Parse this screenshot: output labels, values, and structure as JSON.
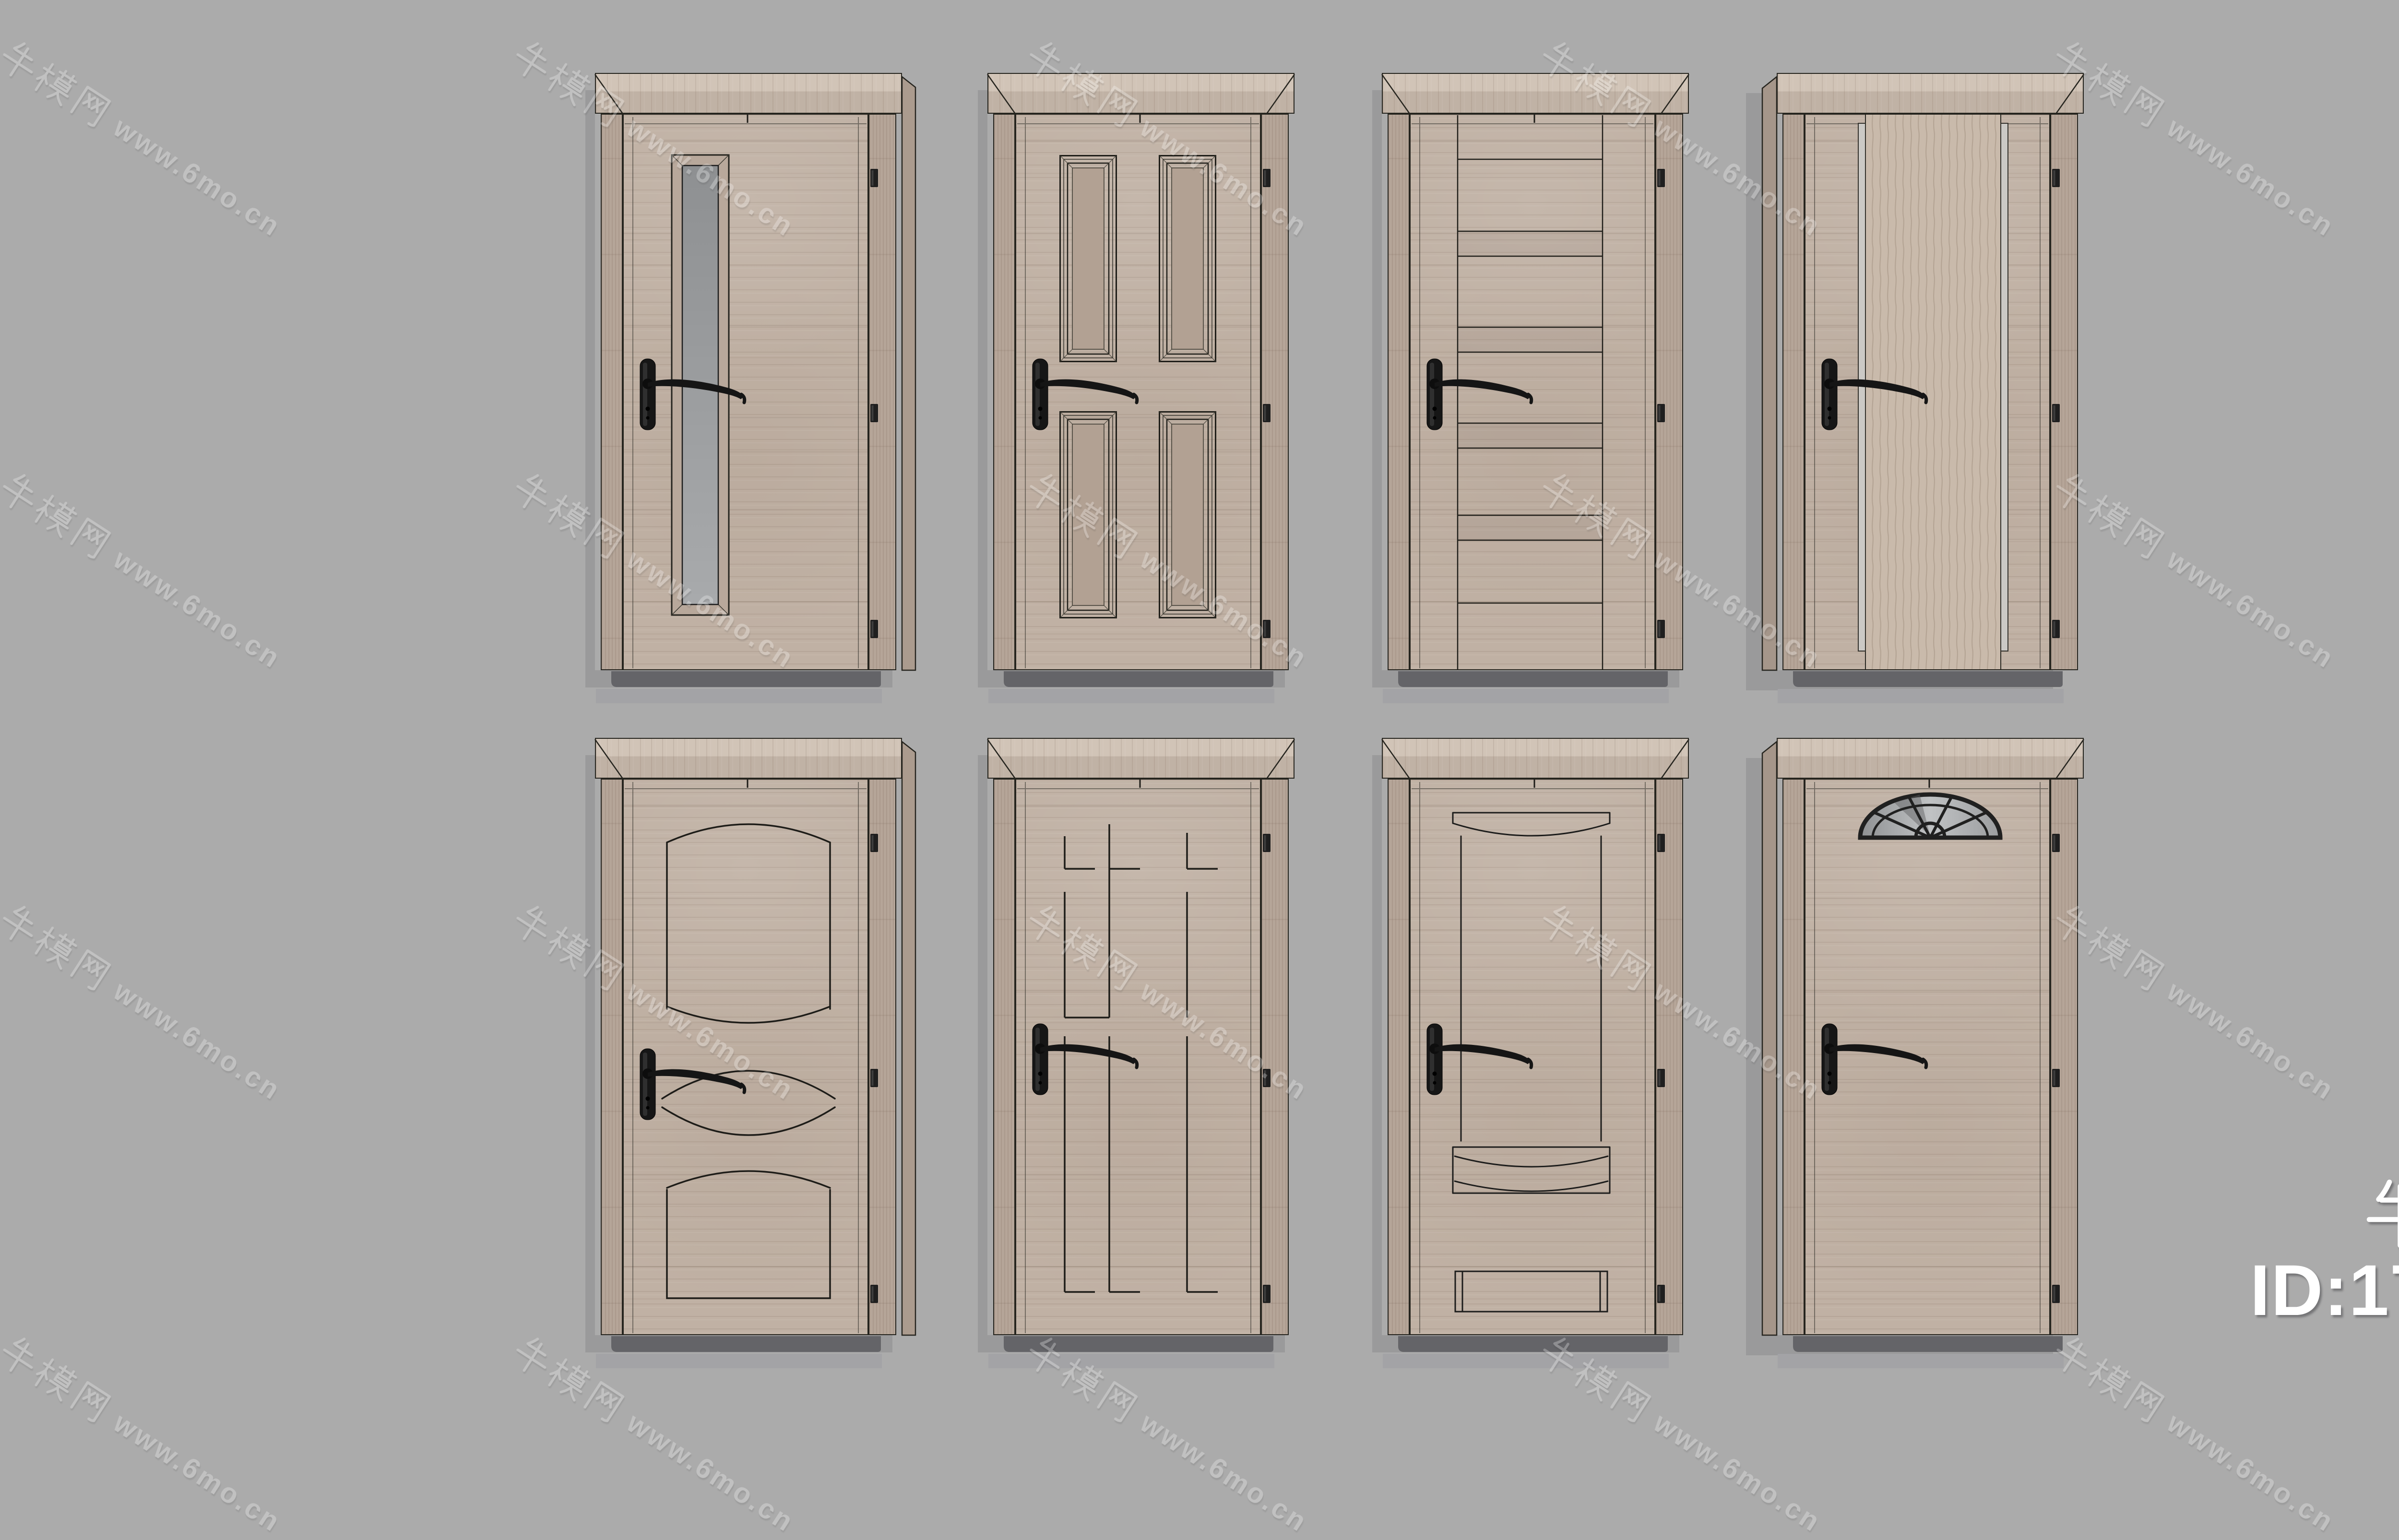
{
  "page": {
    "description": "3D model preview render of eight wooden interior doors",
    "background_color": "#ababab",
    "grid": {
      "rows": 2,
      "cols": 4
    }
  },
  "watermark": {
    "text": "牛模网 www.6mo.cn",
    "chinese": "牛模网",
    "latin": "www.6mo.cn",
    "angle_deg": 33,
    "color": "#ffffff",
    "opacity": 0.27
  },
  "badge": {
    "brand": "牛模网",
    "model_id": "ID:176760",
    "color": "#ffffff"
  },
  "palette": {
    "background": "#ababab",
    "wood": "#c0b1a4",
    "wood_light": "#d1c4b7",
    "wood_dark": "#a5968a",
    "outline": "#26251f",
    "glass": "#97999b",
    "panel_tan": "#b2a193",
    "metal_strip": "#cbc9c5",
    "handle_black": "#151515",
    "wall_shadow": "#9b9b9e",
    "under_door_shadow": "#646468"
  },
  "doors": [
    {
      "id": "door-1",
      "descriptor": "tall-vertical-glass-slot-door"
    },
    {
      "id": "door-2",
      "descriptor": "four-recessed-panel-door"
    },
    {
      "id": "door-3",
      "descriptor": "horizontal-plank-center-door"
    },
    {
      "id": "door-4",
      "descriptor": "vertical-center-board-metal-inlay-door"
    },
    {
      "id": "door-5",
      "descriptor": "arched-panel-oval-groove-door"
    },
    {
      "id": "door-6",
      "descriptor": "geometric-groove-line-door"
    },
    {
      "id": "door-7",
      "descriptor": "arched-band-panel-door"
    },
    {
      "id": "door-8",
      "descriptor": "fanlight-window-door"
    }
  ],
  "hardware": {
    "handle": "black-lever-handle",
    "hinges_per_door": 3
  }
}
